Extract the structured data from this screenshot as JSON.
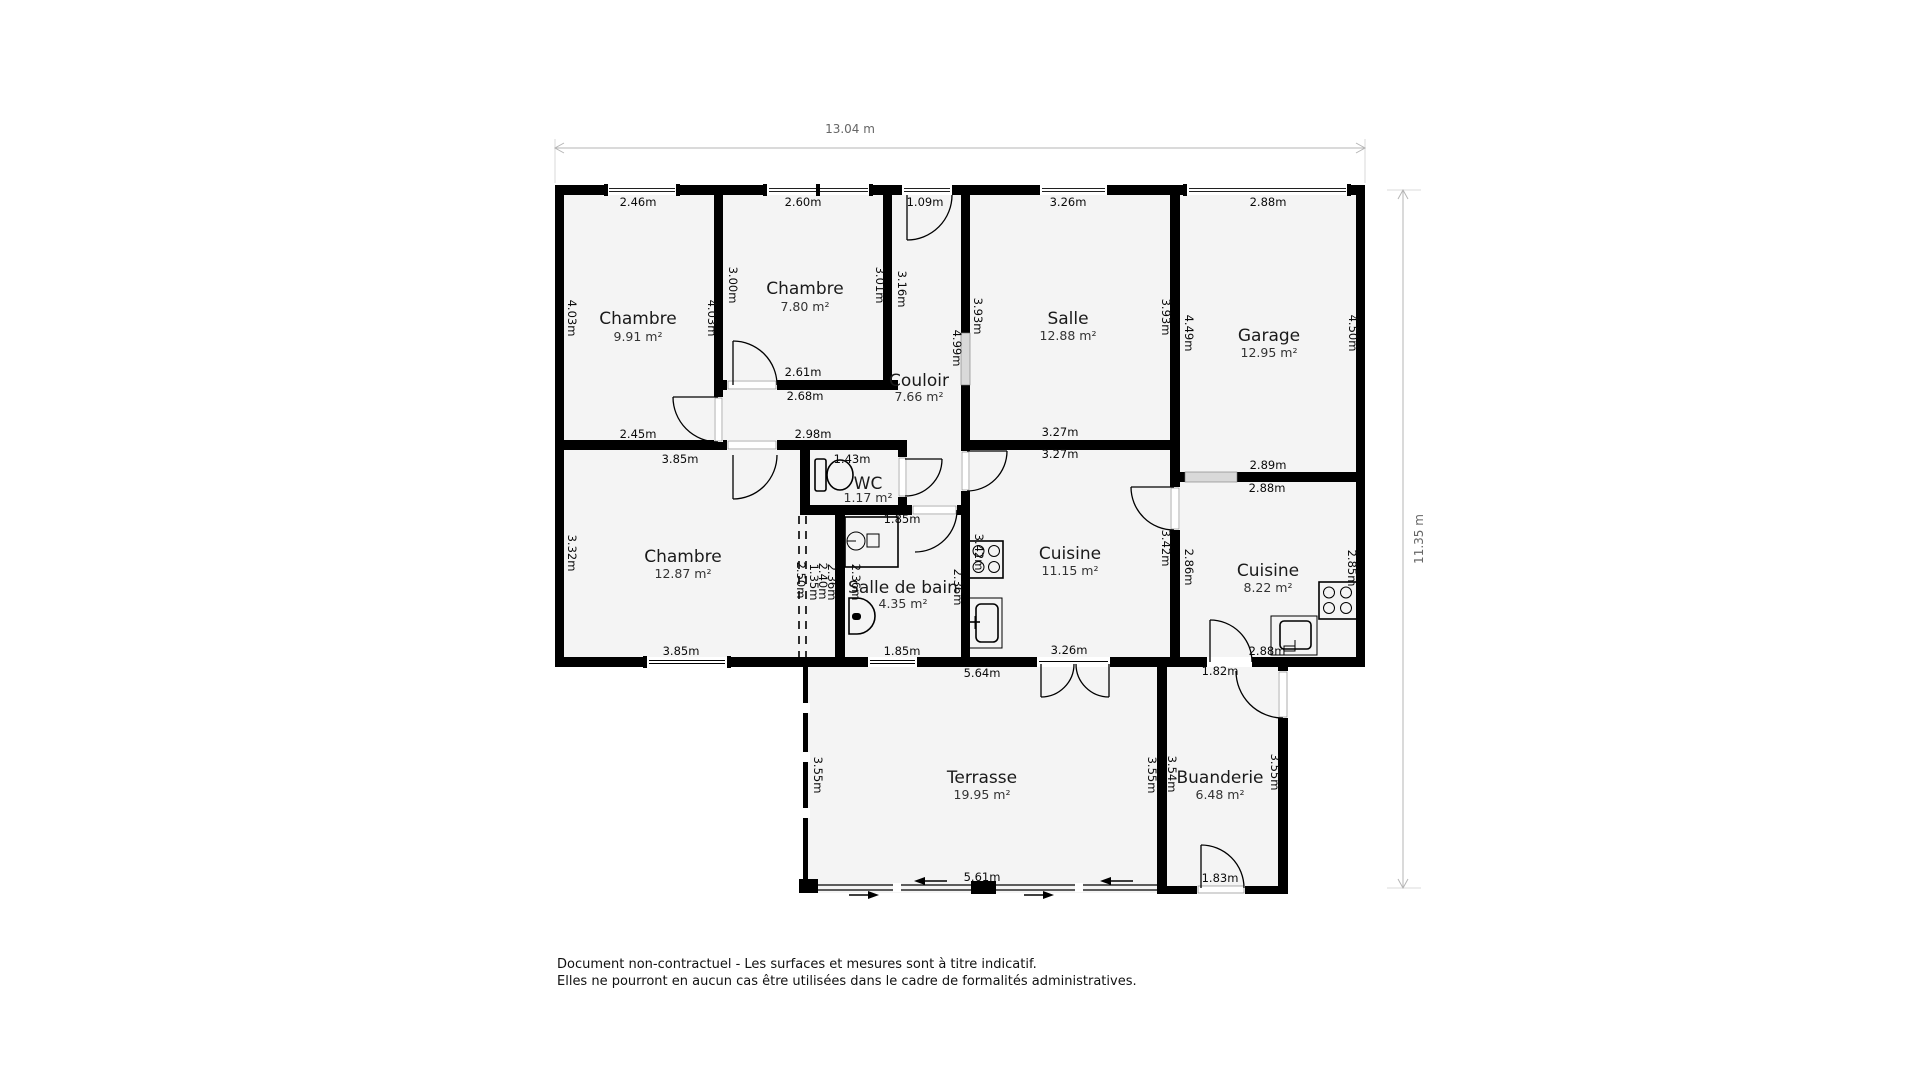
{
  "overall": {
    "width_label": "13.04 m",
    "height_label": "11.35 m"
  },
  "rooms": [
    {
      "id": "chambre-1",
      "name": "Chambre",
      "area": "9.91 m²",
      "x": 638,
      "y": 324,
      "area_y": 341
    },
    {
      "id": "chambre-2",
      "name": "Chambre",
      "area": "7.80 m²",
      "x": 805,
      "y": 294,
      "area_y": 311
    },
    {
      "id": "salle",
      "name": "Salle",
      "area": "12.88 m²",
      "x": 1068,
      "y": 324,
      "area_y": 340
    },
    {
      "id": "garage",
      "name": "Garage",
      "area": "12.95 m²",
      "x": 1269,
      "y": 341,
      "area_y": 357
    },
    {
      "id": "couloir",
      "name": "Couloir",
      "area": "7.66 m²",
      "x": 919,
      "y": 386,
      "area_y": 401
    },
    {
      "id": "wc",
      "name": "WC",
      "area": "1.17 m²",
      "x": 868,
      "y": 489,
      "area_y": 502
    },
    {
      "id": "chambre-3",
      "name": "Chambre",
      "area": "12.87 m²",
      "x": 683,
      "y": 562,
      "area_y": 578
    },
    {
      "id": "salle-de-bain",
      "name": "Salle de bain",
      "area": "4.35 m²",
      "x": 903,
      "y": 593,
      "area_y": 608
    },
    {
      "id": "cuisine-1",
      "name": "Cuisine",
      "area": "11.15 m²",
      "x": 1070,
      "y": 559,
      "area_y": 575
    },
    {
      "id": "cuisine-2",
      "name": "Cuisine",
      "area": "8.22 m²",
      "x": 1268,
      "y": 576,
      "area_y": 592
    },
    {
      "id": "terrasse",
      "name": "Terrasse",
      "area": "19.95 m²",
      "x": 982,
      "y": 783,
      "area_y": 799
    },
    {
      "id": "buanderie",
      "name": "Buanderie",
      "area": "6.48 m²",
      "x": 1220,
      "y": 783,
      "area_y": 799
    }
  ],
  "dimensions": {
    "horizontal": [
      {
        "text": "2.46m",
        "x": 638,
        "y": 206
      },
      {
        "text": "2.60m",
        "x": 803,
        "y": 206
      },
      {
        "text": "1.09m",
        "x": 925,
        "y": 206
      },
      {
        "text": "3.26m",
        "x": 1068,
        "y": 206
      },
      {
        "text": "2.88m",
        "x": 1268,
        "y": 206
      },
      {
        "text": "2.61m",
        "x": 803,
        "y": 376
      },
      {
        "text": "2.68m",
        "x": 805,
        "y": 400
      },
      {
        "text": "2.98m",
        "x": 813,
        "y": 438
      },
      {
        "text": "2.45m",
        "x": 638,
        "y": 438
      },
      {
        "text": "3.27m",
        "x": 1060,
        "y": 436
      },
      {
        "text": "3.27m",
        "x": 1060,
        "y": 458
      },
      {
        "text": "3.85m",
        "x": 680,
        "y": 463
      },
      {
        "text": "1.43m",
        "x": 852,
        "y": 463
      },
      {
        "text": "2.89m",
        "x": 1268,
        "y": 469
      },
      {
        "text": "2.88m",
        "x": 1267,
        "y": 492
      },
      {
        "text": "1.85m",
        "x": 902,
        "y": 523
      },
      {
        "text": "3.85m",
        "x": 681,
        "y": 655
      },
      {
        "text": "1.85m",
        "x": 902,
        "y": 655
      },
      {
        "text": "3.26m",
        "x": 1069,
        "y": 654
      },
      {
        "text": "2.88m",
        "x": 1267,
        "y": 655
      },
      {
        "text": "5.64m",
        "x": 982,
        "y": 677
      },
      {
        "text": "1.82m",
        "x": 1220,
        "y": 675
      },
      {
        "text": "5.61m",
        "x": 982,
        "y": 881
      },
      {
        "text": "1.83m",
        "x": 1220,
        "y": 882
      }
    ],
    "vertical": [
      {
        "text": "4.03m",
        "x": 568,
        "y": 318
      },
      {
        "text": "4.03m",
        "x": 708,
        "y": 318
      },
      {
        "text": "3.00m",
        "x": 729,
        "y": 285
      },
      {
        "text": "3.01m",
        "x": 876,
        "y": 285
      },
      {
        "text": "3.16m",
        "x": 898,
        "y": 289
      },
      {
        "text": "3.93m",
        "x": 974,
        "y": 316
      },
      {
        "text": "4.99m",
        "x": 953,
        "y": 348
      },
      {
        "text": "3.93m",
        "x": 1162,
        "y": 317
      },
      {
        "text": "4.49m",
        "x": 1185,
        "y": 333
      },
      {
        "text": "4.50m",
        "x": 1349,
        "y": 333
      },
      {
        "text": "3.32m",
        "x": 568,
        "y": 553
      },
      {
        "text": "2.50m",
        "x": 797,
        "y": 580
      },
      {
        "text": "1.35m",
        "x": 810,
        "y": 582
      },
      {
        "text": "2.40m",
        "x": 819,
        "y": 581
      },
      {
        "text": "2.36m",
        "x": 828,
        "y": 582
      },
      {
        "text": "2.36m",
        "x": 852,
        "y": 582
      },
      {
        "text": "2.36m",
        "x": 954,
        "y": 587
      },
      {
        "text": "3.42m",
        "x": 975,
        "y": 552
      },
      {
        "text": "3.42m",
        "x": 1162,
        "y": 548
      },
      {
        "text": "2.86m",
        "x": 1185,
        "y": 567
      },
      {
        "text": "2.85m",
        "x": 1348,
        "y": 568
      },
      {
        "text": "3.55m",
        "x": 814,
        "y": 775
      },
      {
        "text": "3.55m",
        "x": 1148,
        "y": 775
      },
      {
        "text": "3.54m",
        "x": 1168,
        "y": 774
      },
      {
        "text": "3.55m",
        "x": 1271,
        "y": 772
      }
    ]
  },
  "fixtures": [
    {
      "name": "toilet-icon",
      "room": "wc"
    },
    {
      "name": "washbasin-icon",
      "room": "salle-de-bain"
    },
    {
      "name": "toilet-icon",
      "room": "salle-de-bain"
    },
    {
      "name": "stove-icon",
      "room": "cuisine-1"
    },
    {
      "name": "sink-icon",
      "room": "cuisine-1"
    },
    {
      "name": "stove-icon",
      "room": "cuisine-2"
    },
    {
      "name": "sink-icon",
      "room": "cuisine-2"
    }
  ],
  "disclaimer": {
    "line1": "Document non-contractuel - Les surfaces et mesures sont à titre indicatif.",
    "line2": "Elles ne pourront en aucun cas être utilisées dans le cadre de formalités administratives."
  }
}
